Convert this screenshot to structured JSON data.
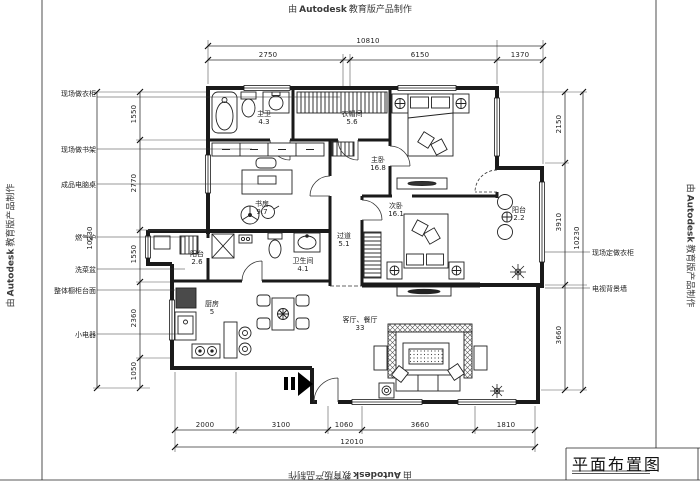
{
  "watermark": {
    "prefix": "由",
    "brand": "Autodesk",
    "suffix": "教育版产品制作"
  },
  "title_block": {
    "title": "平面布置图"
  },
  "dims": {
    "top": {
      "total": "10810",
      "seg1": "2750",
      "seg2": "6150",
      "seg3": "1370"
    },
    "bottom": {
      "total": "12010",
      "seg1": "2000",
      "seg2": "3100",
      "seg3": "1060",
      "seg4": "3660",
      "seg5": "1810"
    },
    "left": {
      "total": "10230",
      "seg1": "1550",
      "seg2": "2770",
      "seg3": "1550",
      "seg4": "2360",
      "seg5": "1050"
    },
    "right": {
      "total": "10230",
      "seg1": "2150",
      "seg2": "3910",
      "seg3": "3660"
    }
  },
  "rooms": {
    "master_bath": {
      "name": "主卫",
      "area": "4.3"
    },
    "cloakroom": {
      "name": "衣帽间",
      "area": "5.6"
    },
    "master_bedroom": {
      "name": "主卧",
      "area": "16.8"
    },
    "study": {
      "name": "书房",
      "area": "9.7"
    },
    "balcony_east": {
      "name": "阳台",
      "area": "2.2"
    },
    "second_bedroom": {
      "name": "次卧",
      "area": "16.1"
    },
    "hallway": {
      "name": "过道",
      "area": "5.1"
    },
    "balcony_west": {
      "name": "阳台",
      "area": "2.6"
    },
    "bathroom": {
      "name": "卫生间",
      "area": "4.1"
    },
    "kitchen": {
      "name": "厨房",
      "area": "5"
    },
    "living_dining": {
      "name": "客厅、餐厅",
      "area": "33"
    }
  },
  "annotations": {
    "left1": "现场做衣柜",
    "left2": "现场做书架",
    "left3": "成品电脑桌",
    "left4": "燃气炉",
    "left5": "洗菜盆",
    "left6": "整体橱柜台面",
    "left7": "小电器",
    "right1": "现场定做衣柜",
    "right2": "电视背景墙"
  },
  "colors": {
    "line": "#1a1a1a",
    "dim_line": "#444",
    "paper": "#ffffff"
  }
}
